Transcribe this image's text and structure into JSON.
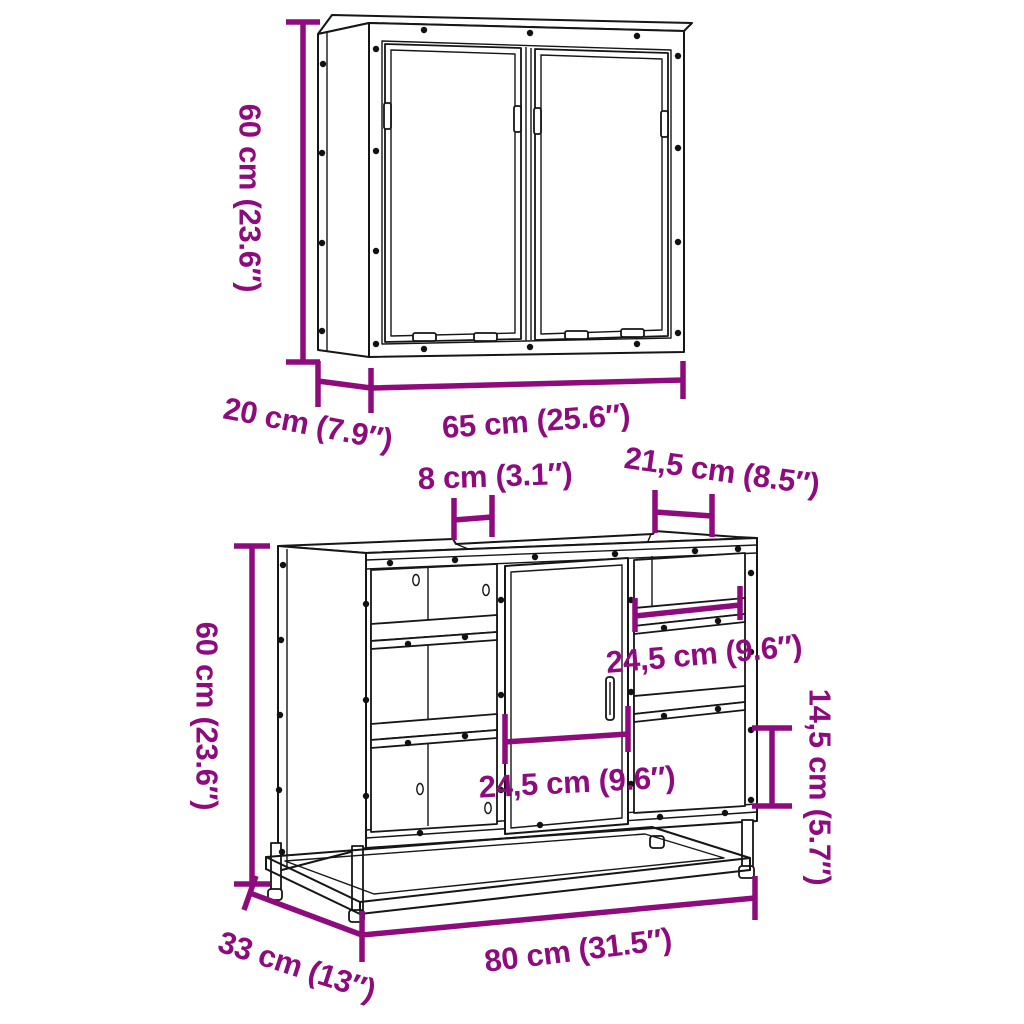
{
  "colors": {
    "annotation": "#8E0B7E",
    "outline": "#161616",
    "background": "#FFFFFF"
  },
  "diagram": {
    "type": "furniture-dimension-diagram",
    "products": {
      "mirror_cabinet": {
        "height": "60 cm (23.6″)",
        "depth": "20 cm (7.9″)",
        "width": "65 cm (25.6″)"
      },
      "sink_cabinet": {
        "top_recess_width": "8 cm (3.1″)",
        "top_right_width": "21,5 cm (8.5″)",
        "height": "60 cm (23.6″)",
        "upper_shelf_width": "24,5 cm (9.6″)",
        "door_width": "24,5 cm (9.6″)",
        "shelf_opening_height": "14,5 cm (5.7″)",
        "depth": "33 cm (13″)",
        "width": "80 cm (31.5″)"
      }
    }
  }
}
